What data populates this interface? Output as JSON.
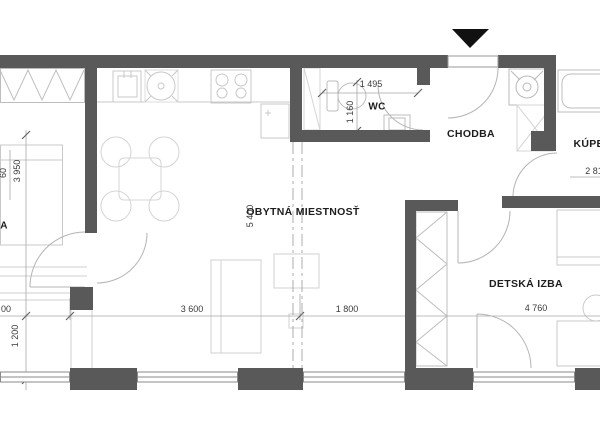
{
  "plan": {
    "labels": {
      "living_room": "OBYTNÁ MIESTNOSŤ",
      "wc": "WC",
      "hallway": "CHODBA",
      "bathroom_partial": "KÚPEĽ",
      "kids_room": "DETSKÁ IZBA",
      "left_room_partial": "A"
    },
    "dimensions": {
      "wc_width": "1 495",
      "wc_depth": "1 160",
      "left_room_height": "3 950",
      "left_room_height_partial": "60",
      "living_depth": "5 400",
      "living_width_a": "3 600",
      "living_width_b": "1 800",
      "kids_width": "4 760",
      "left_bottom_height": "1 200",
      "left_width_partial": "00",
      "bathroom_width_partial": "2 81"
    },
    "colors": {
      "wall": "#595959",
      "window": "#8a8a8a",
      "door_arc": "#b4b4b4",
      "furniture": "#c9c9c9",
      "dimension_line": "#a0a0a0",
      "text": "#3a3a3a",
      "entrance_arrow": "#111111"
    }
  }
}
